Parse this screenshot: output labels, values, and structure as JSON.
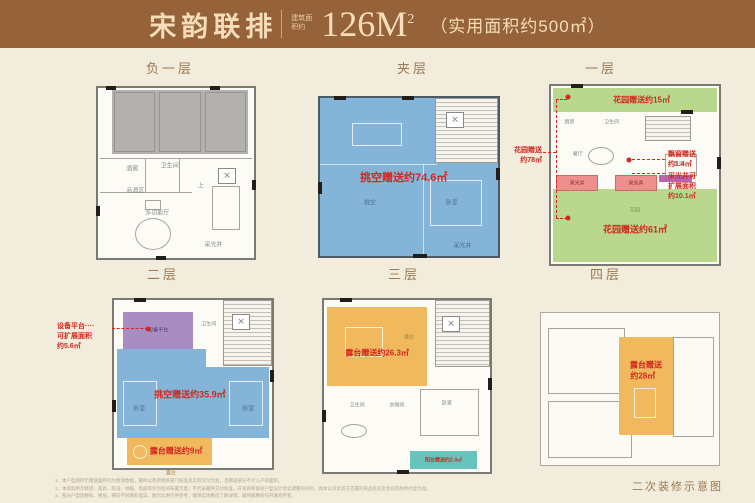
{
  "header": {
    "project_name": "宋韵联排",
    "area_label_small": "建筑面积约",
    "area_value": "126M",
    "area_sup": "2",
    "usable_area": "（实用面积约500㎡）"
  },
  "colors": {
    "header_brown": "#96623a",
    "gift_red": "#d2271d",
    "void_blue": "#84b5d8",
    "garden_green": "#b9d88d",
    "terrace_orange": "#f0b95e",
    "equipment_purple": "#a88cc2",
    "balcony_teal": "#66c4bd",
    "lightwell_pink": "#ee8f8d"
  },
  "floors": [
    {
      "label": "负一层",
      "rooms": {
        "wine_cellar": "酒窖",
        "bathroom": "卫生间",
        "tasting_area": "品酒区",
        "multi_hall": "多功能厅",
        "light_well": "采光井",
        "up": "上"
      }
    },
    {
      "label": "夹层",
      "gift": "挑空赠送约74.6㎡",
      "rooms": {
        "void": "挑空",
        "bedroom": "卧室",
        "light_well": "采光井"
      }
    },
    {
      "label": "一层",
      "garden_top_gift": "花园赠送约15㎡",
      "garden_bottom_gift": "花园赠送约61㎡",
      "garden_side_l1": "花园赠送",
      "garden_side_l2": "约78㎡",
      "bay_l1": "飘窗赠送",
      "bay_l2": "约1.4㎡",
      "lw_l1": "采光井可",
      "lw_l2": "扩展面积",
      "lw_l3": "约10.1㎡",
      "rooms": {
        "kitchen": "厨房",
        "bathroom": "卫生间",
        "dining": "餐厅",
        "bedroom": "卧室",
        "light_well_1": "采光井",
        "light_well_2": "采光井",
        "garden": "花园"
      }
    },
    {
      "label": "二层",
      "gift": "挑空赠送约35.9㎡",
      "terrace_gift": "露台赠送约9㎡",
      "equip_l1": "设备平台····",
      "equip_l2": "可扩展面积",
      "equip_l3": "约5.6㎡",
      "rooms": {
        "equipment": "设备平台",
        "bathroom": "卫生间",
        "bedroom_left": "卧室",
        "bedroom_right": "卧室",
        "terrace": "露台"
      }
    },
    {
      "label": "三层",
      "terrace_gift": "露台赠送约26.3㎡",
      "balcony_gift": "阳台赠送约2.4㎡",
      "rooms": {
        "terrace": "露台",
        "bathroom": "卫生间",
        "cloakroom": "衣帽间",
        "bedroom": "卧室"
      }
    },
    {
      "label": "四层",
      "terrace_l1": "露台赠送",
      "terrace_l2": "约28㎡"
    }
  ],
  "footer": {
    "disclaimers": [
      "1、本户型图所示赠送面积均为暂测数据，最终以政府相关部门核准及实际交付为准，且赠送部分不计入产权面积。",
      "2、本资料所示装修、家具、陈设、绿植、电器等仅为空间布置示意，不代表最终交付标准，开发商保留对户型设计优化调整的权利，具体以买卖双方签署的商品房买卖合同及附件约定为准。",
      "3、部分户型因楼栋、楼层、朝向不同略有差异，图示比例仅供参考，敬请实地看房了解详情，最终解释权归开发商所有。"
    ],
    "note": "二次装修示意图"
  }
}
